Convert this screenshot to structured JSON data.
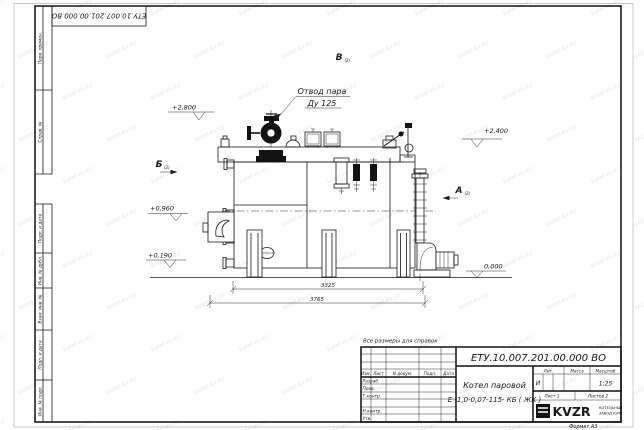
{
  "frame": {
    "doc_number_top": "ЕТУ.10.007.201.00.000  ВО",
    "format_label": "Формат  А3",
    "margin_labels_top": [
      "Перв. примен.",
      "Справ. №"
    ],
    "margin_labels_bottom": [
      "Подп. и дата",
      "Инв. № дубл.",
      "Взам. инв. №",
      "Подп. и дата",
      "Инв. № подл."
    ]
  },
  "watermark": {
    "text": "kotel-kv.kz"
  },
  "drawing": {
    "note": "Все размеры для справок",
    "steam_outlet_label_1": "Отвод пара",
    "steam_outlet_label_2": "Ду 125",
    "view_b_top": "В",
    "view_b_left": "Б",
    "view_a_right": "А",
    "view_sheet_ref": "(2)",
    "elev_2800": "+2,800",
    "elev_2400": "+2,400",
    "elev_0960": "+0,960",
    "elev_0190": "+0,190",
    "elev_0000": "0,000",
    "dim_inner": "3325",
    "dim_outer": "3765"
  },
  "title_block": {
    "designation": "ЕТУ.10.007.201.00.000  ВО",
    "product_name_line1": "Котел паровой",
    "product_name_line2": "Е -1,0-0,07-115- КБ ( ЖК )",
    "col_izm": "Изм.",
    "col_list": "Лист",
    "col_ndoc": "N докум.",
    "col_podp": "Подп.",
    "col_data": "Дата",
    "row_razrab": "Разраб.",
    "row_prov": "Пров.",
    "row_tkontr": "Т.контр.",
    "row_nkontr": "Н.контр.",
    "row_utv": "Утв.",
    "lit_header": "Лит.",
    "mass_header": "Масса",
    "scale_header": "Масштаб",
    "lit_value": "И",
    "scale_value": "1:25",
    "sheet_info": "Лист  1",
    "sheets_info": "Листов  2",
    "logo_text": "KVZR",
    "logo_caption_line1": "КОТЕЛЬНЫЙ",
    "logo_caption_line2": "ЗАВОД РЭП"
  }
}
